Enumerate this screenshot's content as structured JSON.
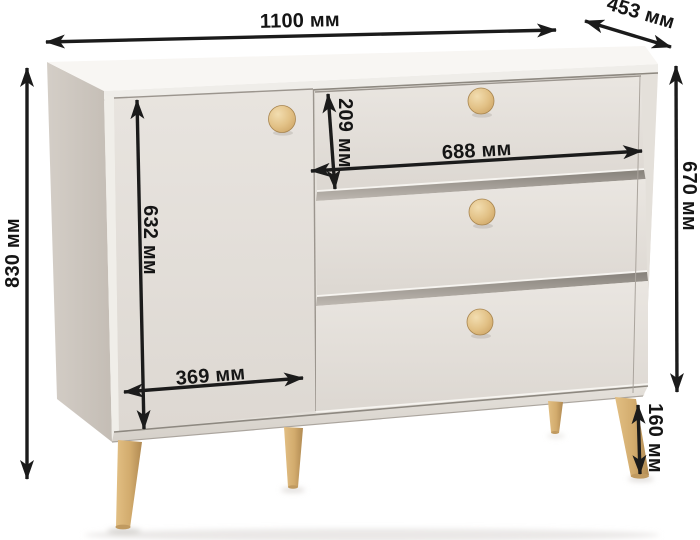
{
  "meta": {
    "unit": "мм",
    "subject": "dresser-dimension-diagram"
  },
  "colors": {
    "background": "#ffffff",
    "top_surface": "#f8f6f3",
    "front_body": "#e4e0da",
    "door": "#e6e2dd",
    "drawer": "#e9e5e0",
    "side_panel": "#cbc4bc",
    "wood": "#d9b274",
    "dimension_ink": "#1b1b1b"
  },
  "dimensions": {
    "width": {
      "label": "1100 мм",
      "value_mm": 1100
    },
    "depth": {
      "label": "453 мм",
      "value_mm": 453
    },
    "total_height": {
      "label": "830 мм",
      "value_mm": 830
    },
    "body_height": {
      "label": "670 мм",
      "value_mm": 670
    },
    "door_height": {
      "label": "632 мм",
      "value_mm": 632
    },
    "door_width": {
      "label": "369 мм",
      "value_mm": 369
    },
    "top_drawer_height": {
      "label": "209 мм",
      "value_mm": 209
    },
    "drawer_width": {
      "label": "688 мм",
      "value_mm": 688
    },
    "leg_height": {
      "label": "160 мм",
      "value_mm": 160
    }
  }
}
